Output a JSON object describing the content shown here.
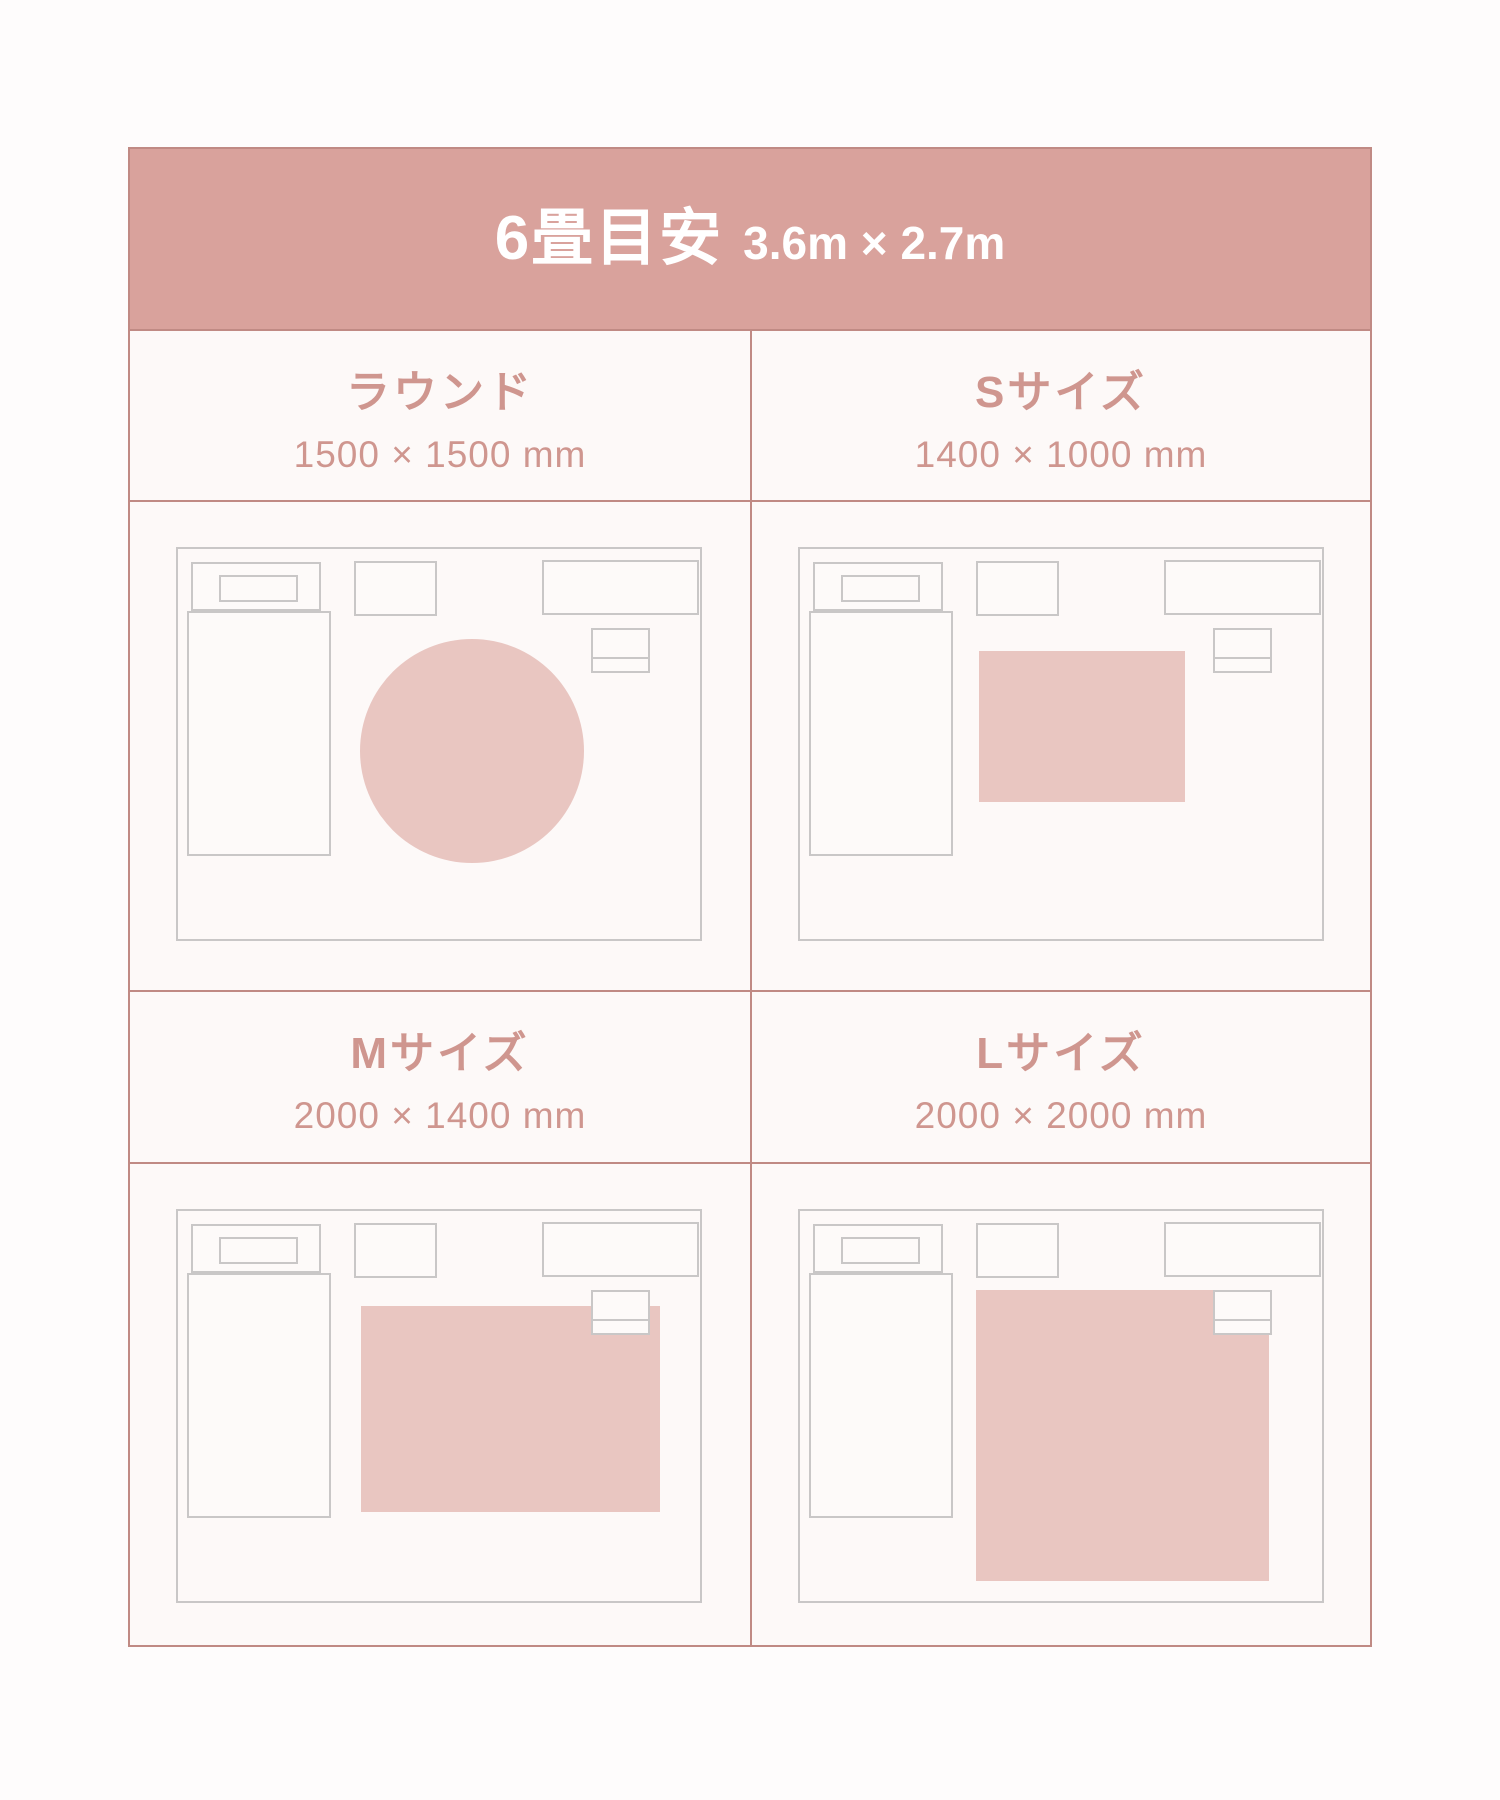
{
  "header": {
    "title": "6畳目安",
    "room_size": "3.6m × 2.7m"
  },
  "quadrants": [
    {
      "name": "round",
      "label": "ラウンド",
      "size": "1500 × 1500 mm",
      "rug_shape": "circle",
      "rug_px": {
        "x": 182,
        "y": 90,
        "w": 224,
        "h": 224
      }
    },
    {
      "name": "s-size",
      "label": "Sサイズ",
      "size": "1400 × 1000 mm",
      "rug_shape": "rect",
      "rug_px": {
        "x": 179,
        "y": 102,
        "w": 206,
        "h": 151
      }
    },
    {
      "name": "m-size",
      "label": "Mサイズ",
      "size": "2000 × 1400 mm",
      "rug_shape": "rect",
      "rug_px": {
        "x": 183,
        "y": 95,
        "w": 299,
        "h": 206
      }
    },
    {
      "name": "l-size",
      "label": "Lサイズ",
      "size": "2000 × 2000 mm",
      "rug_shape": "rect",
      "rug_px": {
        "x": 176,
        "y": 79,
        "w": 293,
        "h": 291
      }
    }
  ],
  "room": {
    "scale_note": "plan view of 6-tatami room",
    "furniture": [
      "bed-headboard",
      "bed-pillow",
      "bed",
      "side-table",
      "desk",
      "chair"
    ]
  },
  "colors": {
    "page_bg": "#fefcfc",
    "cell_bg": "#fdf9f8",
    "header_bg": "#d9a29c",
    "header_text": "#ffffff",
    "label_text": "#cf968f",
    "line": "#c08a84",
    "outline": "#c9c7c7",
    "furn_fill": "#fdfaf9",
    "rug_fill": "#e9c6c1"
  }
}
